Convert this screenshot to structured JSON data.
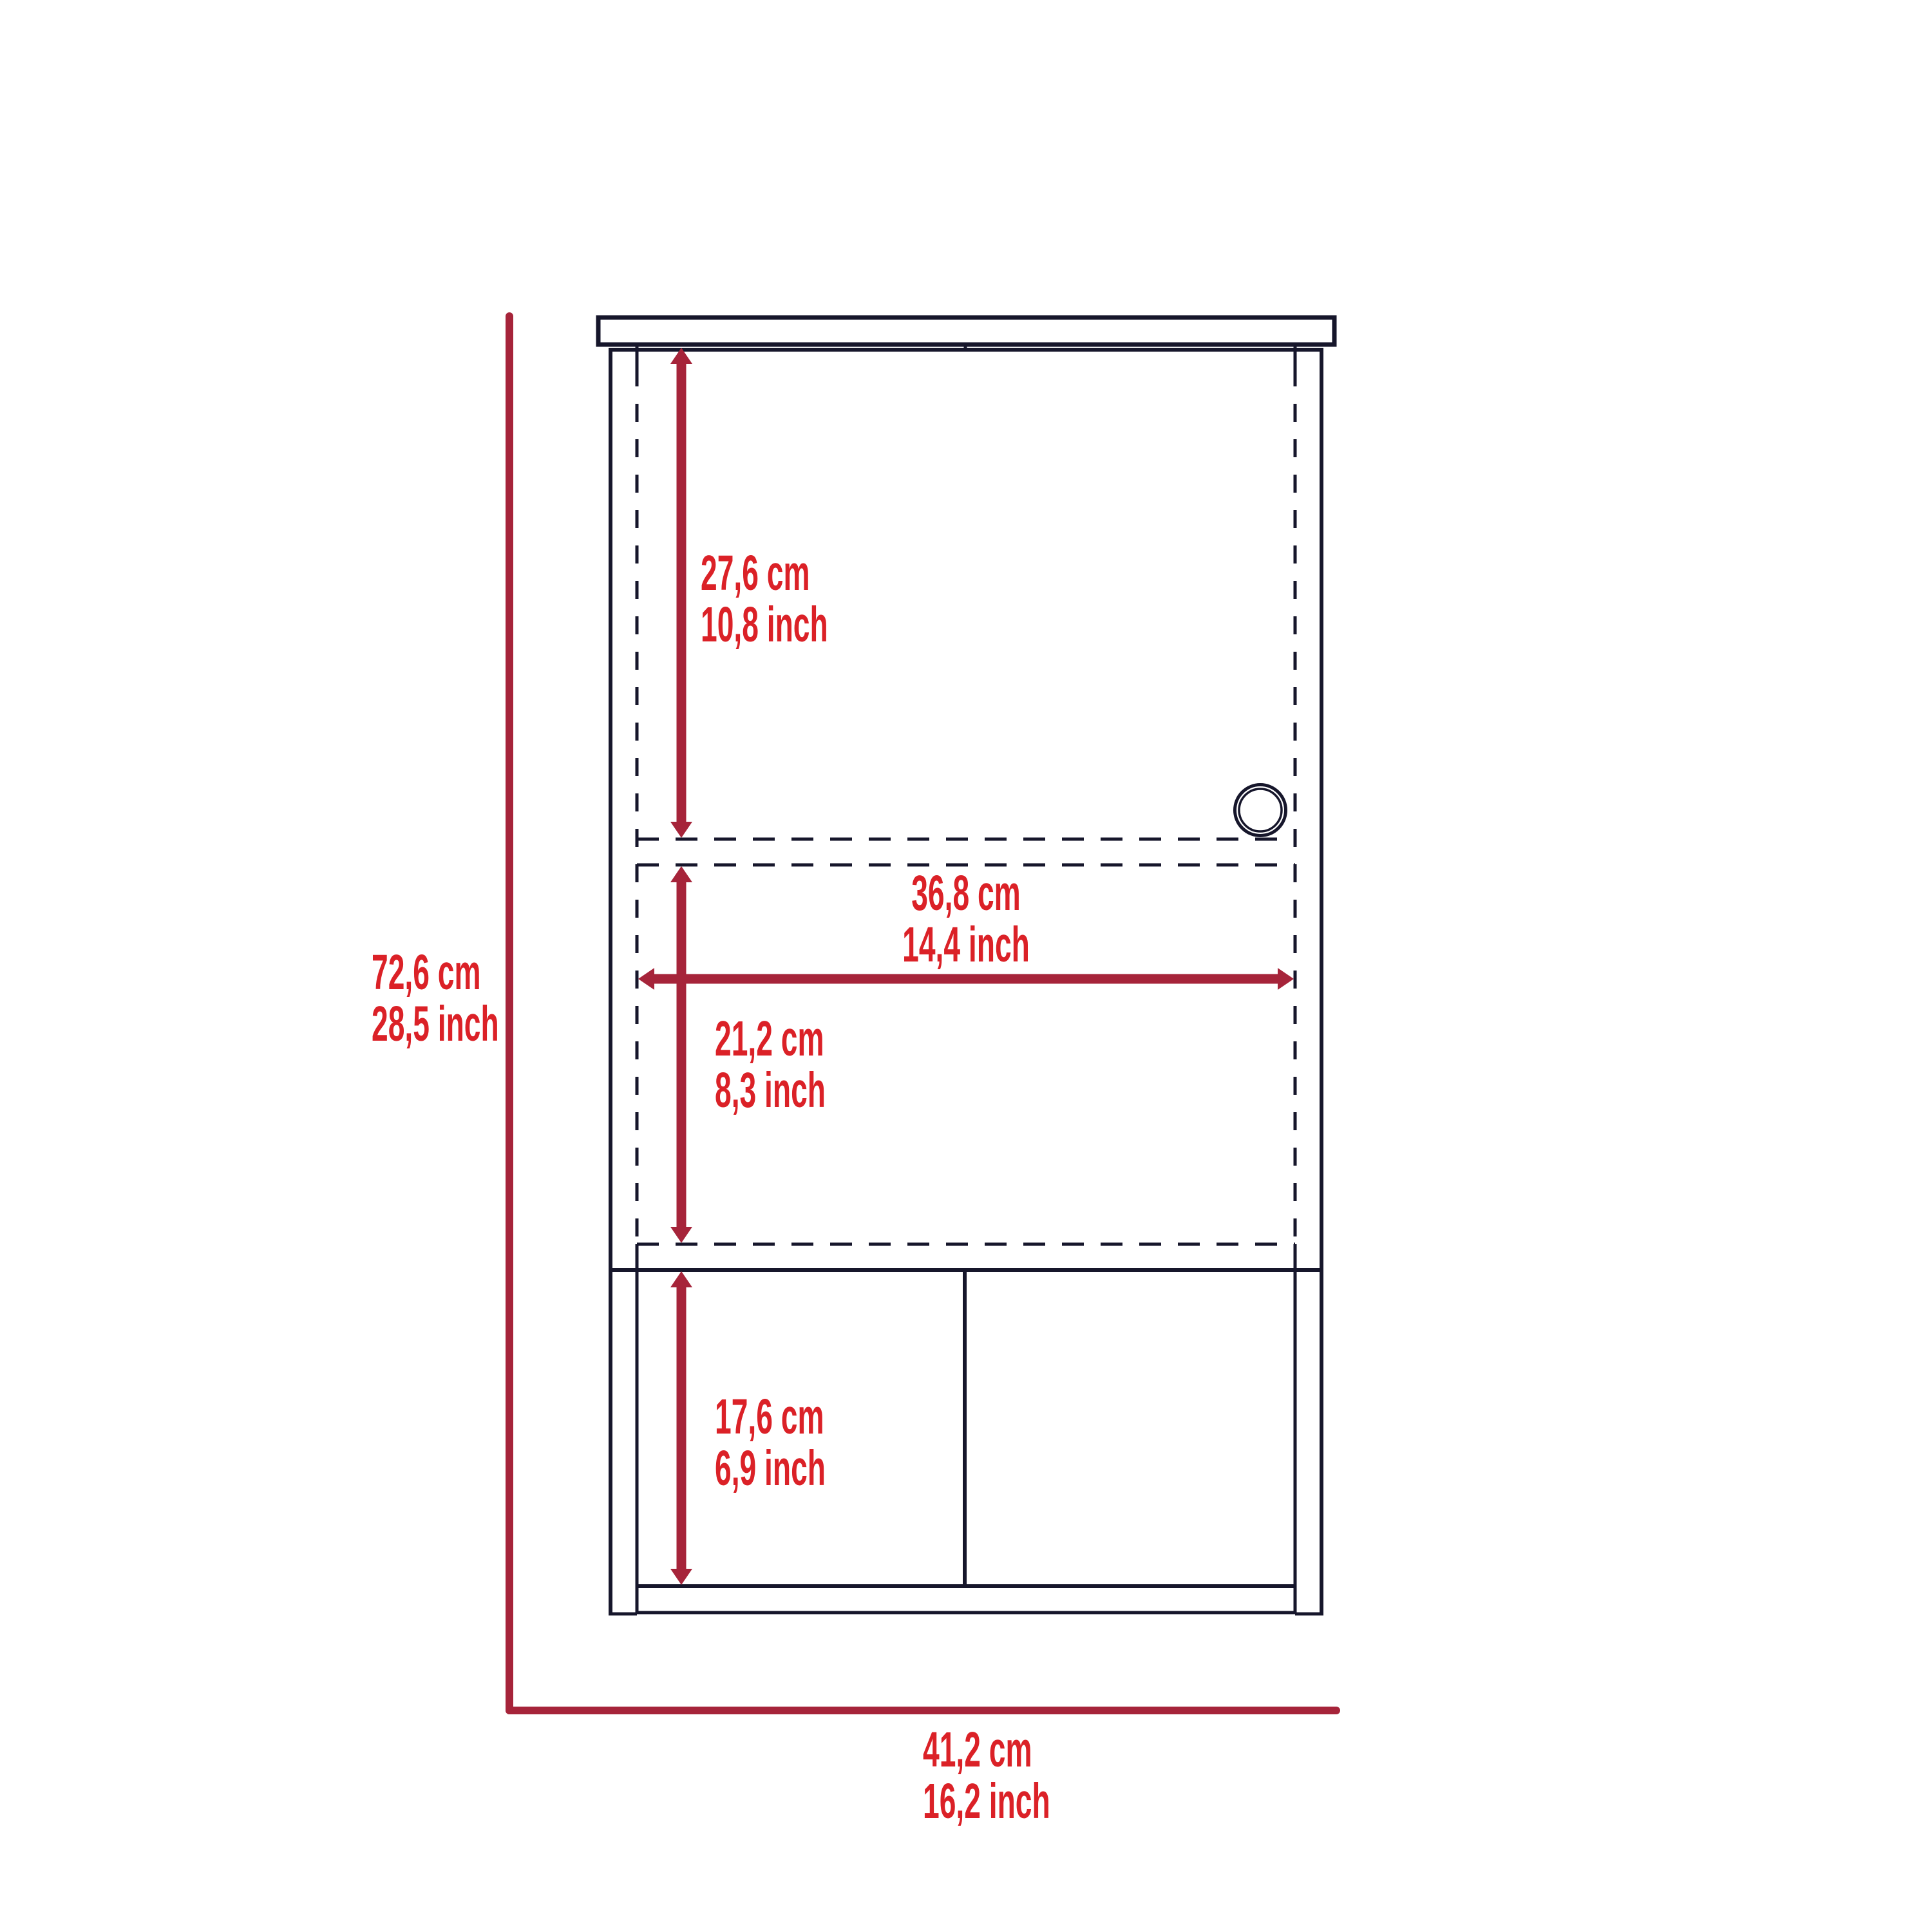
{
  "diagram": {
    "type": "furniture-dimension-drawing",
    "subject": "wall cabinet front view",
    "colors": {
      "background": "#FFFFFF",
      "drawing_line": "#16162B",
      "dimension_line": "#A6243A",
      "dimension_text": "#DB2127"
    },
    "dimensions": {
      "overall_height": {
        "cm": "72,6 cm",
        "inch": "28,5 inch"
      },
      "overall_width": {
        "cm": "41,2 cm",
        "inch": "16,2 inch"
      },
      "upper_section_height": {
        "cm": "27,6 cm",
        "inch": "10,8 inch"
      },
      "interior_width": {
        "cm": "36,8 cm",
        "inch": "14,4 inch"
      },
      "middle_section_height": {
        "cm": "21,2 cm",
        "inch": "8,3 inch"
      },
      "lower_section_height": {
        "cm": "17,6 cm",
        "inch": "6,9 inch"
      }
    }
  }
}
